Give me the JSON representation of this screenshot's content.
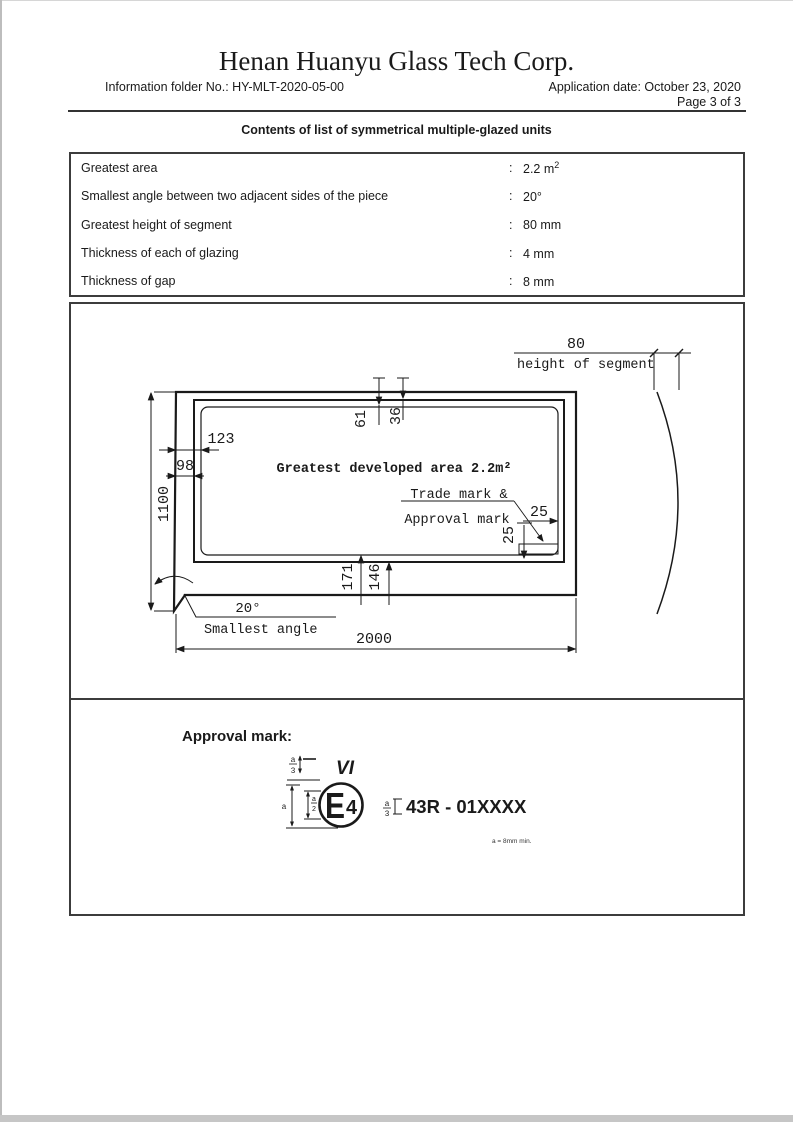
{
  "header": {
    "company": "Henan Huanyu Glass Tech Corp.",
    "folder_no": "Information folder No.: HY-MLT-2020-05-00",
    "application_date": "Application date: October 23, 2020",
    "page_info": "Page 3 of 3",
    "doc_title": "Contents of list of symmetrical multiple-glazed units"
  },
  "spec_table": {
    "rows": [
      {
        "label": "Greatest area",
        "sep": ":",
        "value": "2.2 m",
        "value_sup": "2"
      },
      {
        "label": "Smallest angle between two adjacent sides of the piece",
        "sep": ":",
        "value": "20°",
        "value_sup": ""
      },
      {
        "label": "Greatest height of segment",
        "sep": ":",
        "value": "80 mm",
        "value_sup": ""
      },
      {
        "label": "Thickness of each of glazing",
        "sep": ":",
        "value": "4 mm",
        "value_sup": ""
      },
      {
        "label": "Thickness of gap",
        "sep": ":",
        "value": "8 mm",
        "value_sup": ""
      }
    ]
  },
  "drawing": {
    "dims": {
      "d80": "80",
      "height_of_segment": "height of segment",
      "d61": "61",
      "d36": "36",
      "d123": "123",
      "d98": "98",
      "d1100": "1100",
      "d171": "171",
      "d146": "146",
      "d25h": "25",
      "d25v": "25",
      "d2000": "2000",
      "angle": "20°"
    },
    "labels": {
      "area": "Greatest developed area 2.2m²",
      "trademark_1": "Trade mark &",
      "trademark_2": "Approval mark",
      "smallest_angle": "Smallest angle"
    }
  },
  "approval": {
    "heading": "Approval mark:",
    "class_label": "VI",
    "e_letter": "E",
    "e_number": "4",
    "regulation_code": "43R - 01XXXX",
    "dim_a": "a",
    "frac_a": "a",
    "frac_3": "3",
    "frac_2": "2",
    "note": "a = 8mm min."
  }
}
